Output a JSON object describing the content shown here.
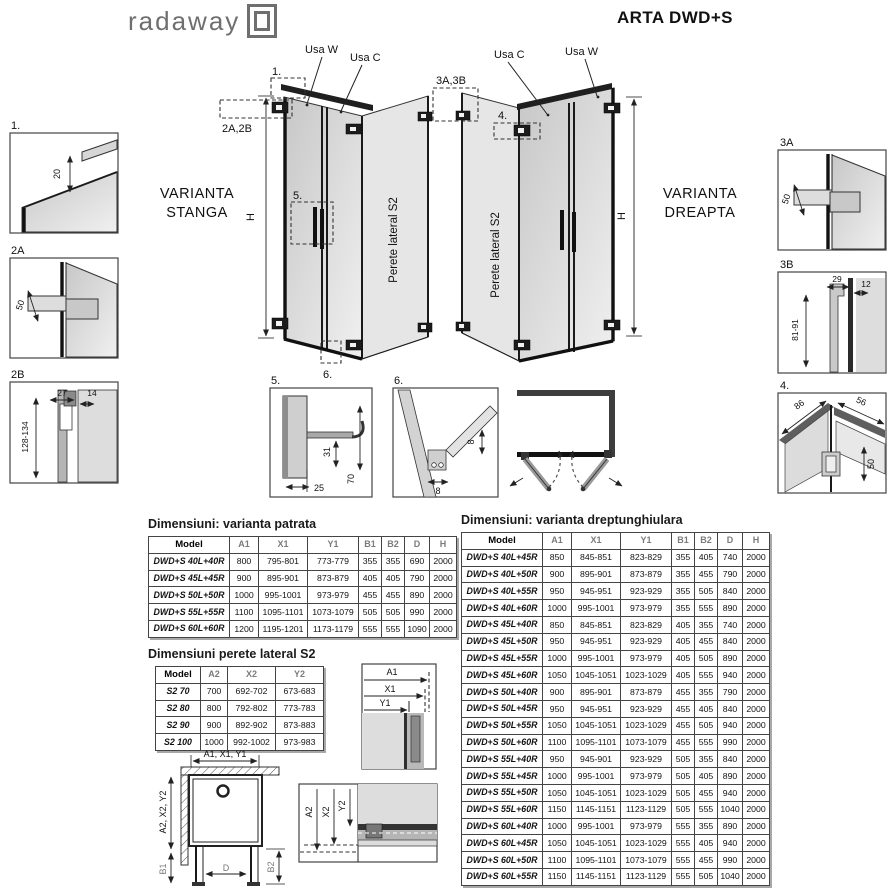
{
  "header": {
    "logo": "radaway",
    "title": "ARTA DWD+S"
  },
  "diagram_left": {
    "variant1": "VARIANTA",
    "variant2": "STANGA",
    "usa_w": "Usa W",
    "usa_c": "Usa C",
    "h": "H",
    "side": "Perete lateral S2",
    "c1": "1.",
    "c2": "2A,2B",
    "c5": "5.",
    "c6": "6."
  },
  "diagram_right": {
    "variant1": "VARIANTA",
    "variant2": "DREAPTA",
    "usa_c": "Usa C",
    "usa_w": "Usa W",
    "h": "H",
    "side": "Perete lateral S2",
    "c3": "3A,3B",
    "c4": "4."
  },
  "details": {
    "d1": {
      "label": "1.",
      "d20": "20"
    },
    "d2a": {
      "label": "2A",
      "d50": "50"
    },
    "d2b": {
      "label": "2B",
      "d27": "27",
      "d14": "14",
      "dr": "128-134"
    },
    "d3a": {
      "label": "3A",
      "d50": "50"
    },
    "d3b": {
      "label": "3B",
      "d29": "29",
      "d12": "12",
      "dr": "81-91"
    },
    "d4": {
      "label": "4.",
      "d86": "86",
      "d56": "56",
      "d50": "50"
    },
    "d5": {
      "label": "5.",
      "d25": "25",
      "d31": "31",
      "d70": "70"
    },
    "d6": {
      "label": "6.",
      "d8a": "8",
      "d8b": "8"
    }
  },
  "bottom": {
    "plan": {
      "top": "A1, X1, Y1",
      "left": "A2, X2, Y2",
      "b1": "B1",
      "d": "D",
      "b2": "B2"
    },
    "s_top": {
      "a1": "A1",
      "x1": "X1",
      "y1": "Y1"
    },
    "s_bot": {
      "a2": "A2",
      "x2": "X2",
      "y2": "Y2"
    }
  },
  "tables": {
    "patrata": {
      "title": "Dimensiuni: varianta patrata",
      "headers": [
        "Model",
        "A1",
        "X1",
        "Y1",
        "B1",
        "B2",
        "D",
        "H"
      ],
      "rows": [
        [
          "DWD+S 40L+40R",
          "800",
          "795-801",
          "773-779",
          "355",
          "355",
          "690",
          "2000"
        ],
        [
          "DWD+S 45L+45R",
          "900",
          "895-901",
          "873-879",
          "405",
          "405",
          "790",
          "2000"
        ],
        [
          "DWD+S 50L+50R",
          "1000",
          "995-1001",
          "973-979",
          "455",
          "455",
          "890",
          "2000"
        ],
        [
          "DWD+S 55L+55R",
          "1100",
          "1095-1101",
          "1073-1079",
          "505",
          "505",
          "990",
          "2000"
        ],
        [
          "DWD+S 60L+60R",
          "1200",
          "1195-1201",
          "1173-1179",
          "555",
          "555",
          "1090",
          "2000"
        ]
      ]
    },
    "s2": {
      "title": "Dimensiuni perete lateral S2",
      "headers": [
        "Model",
        "A2",
        "X2",
        "Y2"
      ],
      "rows": [
        [
          "S2 70",
          "700",
          "692-702",
          "673-683"
        ],
        [
          "S2 80",
          "800",
          "792-802",
          "773-783"
        ],
        [
          "S2 90",
          "900",
          "892-902",
          "873-883"
        ],
        [
          "S2 100",
          "1000",
          "992-1002",
          "973-983"
        ]
      ]
    },
    "dreptunghiulara": {
      "title": "Dimensiuni: varianta dreptunghiulara",
      "headers": [
        "Model",
        "A1",
        "X1",
        "Y1",
        "B1",
        "B2",
        "D",
        "H"
      ],
      "rows": [
        [
          "DWD+S 40L+45R",
          "850",
          "845-851",
          "823-829",
          "355",
          "405",
          "740",
          "2000"
        ],
        [
          "DWD+S 40L+50R",
          "900",
          "895-901",
          "873-879",
          "355",
          "455",
          "790",
          "2000"
        ],
        [
          "DWD+S 40L+55R",
          "950",
          "945-951",
          "923-929",
          "355",
          "505",
          "840",
          "2000"
        ],
        [
          "DWD+S 40L+60R",
          "1000",
          "995-1001",
          "973-979",
          "355",
          "555",
          "890",
          "2000"
        ],
        [
          "DWD+S 45L+40R",
          "850",
          "845-851",
          "823-829",
          "405",
          "355",
          "740",
          "2000"
        ],
        [
          "DWD+S 45L+50R",
          "950",
          "945-951",
          "923-929",
          "405",
          "455",
          "840",
          "2000"
        ],
        [
          "DWD+S 45L+55R",
          "1000",
          "995-1001",
          "973-979",
          "405",
          "505",
          "890",
          "2000"
        ],
        [
          "DWD+S 45L+60R",
          "1050",
          "1045-1051",
          "1023-1029",
          "405",
          "555",
          "940",
          "2000"
        ],
        [
          "DWD+S 50L+40R",
          "900",
          "895-901",
          "873-879",
          "455",
          "355",
          "790",
          "2000"
        ],
        [
          "DWD+S 50L+45R",
          "950",
          "945-951",
          "923-929",
          "455",
          "405",
          "840",
          "2000"
        ],
        [
          "DWD+S 50L+55R",
          "1050",
          "1045-1051",
          "1023-1029",
          "455",
          "505",
          "940",
          "2000"
        ],
        [
          "DWD+S 50L+60R",
          "1100",
          "1095-1101",
          "1073-1079",
          "455",
          "555",
          "990",
          "2000"
        ],
        [
          "DWD+S 55L+40R",
          "950",
          "945-901",
          "923-929",
          "505",
          "355",
          "840",
          "2000"
        ],
        [
          "DWD+S 55L+45R",
          "1000",
          "995-1001",
          "973-979",
          "505",
          "405",
          "890",
          "2000"
        ],
        [
          "DWD+S 55L+50R",
          "1050",
          "1045-1051",
          "1023-1029",
          "505",
          "455",
          "940",
          "2000"
        ],
        [
          "DWD+S 55L+60R",
          "1150",
          "1145-1151",
          "1123-1129",
          "505",
          "555",
          "1040",
          "2000"
        ],
        [
          "DWD+S 60L+40R",
          "1000",
          "995-1001",
          "973-979",
          "555",
          "355",
          "890",
          "2000"
        ],
        [
          "DWD+S 60L+45R",
          "1050",
          "1045-1051",
          "1023-1029",
          "555",
          "405",
          "940",
          "2000"
        ],
        [
          "DWD+S 60L+50R",
          "1100",
          "1095-1101",
          "1073-1079",
          "555",
          "455",
          "990",
          "2000"
        ],
        [
          "DWD+S 60L+55R",
          "1150",
          "1145-1151",
          "1123-1129",
          "555",
          "505",
          "1040",
          "2000"
        ]
      ]
    }
  }
}
